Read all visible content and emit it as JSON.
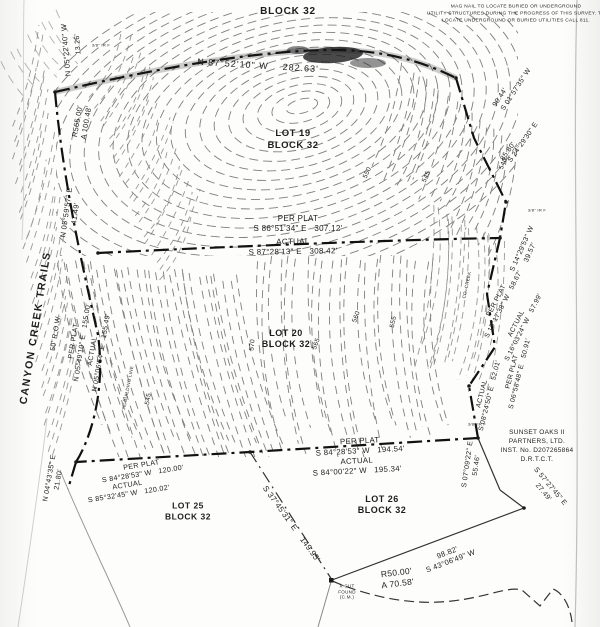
{
  "document": {
    "kind": "scanned survey plat",
    "street": "CANYON CREEK TRAILS",
    "right_of_way": "50' R.O.W.",
    "owner_record": "SUNSET OAKS II PARTNERS, LTD. INST. No. D207265864 D.R.T.C.T."
  },
  "labels": [
    {
      "id": "block-label-top",
      "text": "BLOCK 32",
      "x": 288,
      "y": 12,
      "fs": 10,
      "w": 700,
      "ls": 0.8
    },
    {
      "id": "utility-note",
      "text": "MAG NAIL TO LOCATE BURIED OR UNDERGROUND\nUTILITY STRUCTURES DURING THE PROGRESS OF THIS SURVEY. TO\nLOCATE UNDERGROUND OR BURIED UTILITIES CALL 811.",
      "x": 516,
      "y": 15,
      "fs": 4.8,
      "lh": 1.45
    },
    {
      "id": "bearing-top-n875210",
      "text": "N 87°52'10\" W    282.63'",
      "x": 258,
      "y": 66,
      "rot": 3.5,
      "fs": 9,
      "ls": 1
    },
    {
      "id": "dist-13-26",
      "text": "13.26'",
      "x": 79,
      "y": 44,
      "rot": -95,
      "fs": 7
    },
    {
      "id": "bearing-n052240",
      "text": "N 05°22'40\" W",
      "x": 66,
      "y": 50,
      "rot": -95,
      "fs": 7.5
    },
    {
      "id": "monument-irf-1",
      "text": "3/8\" IR F",
      "x": 101,
      "y": 45,
      "fs": 4
    },
    {
      "id": "curve-r565",
      "text": "R565.00'\nA 100.48'",
      "x": 82,
      "y": 122,
      "rot": -80,
      "fs": 7.5
    },
    {
      "id": "bearing-n055957",
      "text": "N 05°59'57\" E\n41.49'",
      "x": 71,
      "y": 213,
      "rot": -82,
      "fs": 7.5
    },
    {
      "id": "street-name",
      "text": "CANYON CREEK TRAILS",
      "x": 36,
      "y": 328,
      "rot": -81,
      "fs": 10.5,
      "ls": 1.5,
      "w": 600
    },
    {
      "id": "street-row",
      "text": "50' R.O.W.",
      "x": 57,
      "y": 333,
      "rot": -81,
      "fs": 7
    },
    {
      "id": "perplat-road",
      "text": "PER PLAT\nN 05°49'10\" E   155.00'",
      "x": 79,
      "y": 342,
      "rot": -81,
      "fs": 7
    },
    {
      "id": "actual-road",
      "text": "ACTUAL\nN 05°06'54\" E   155.49'",
      "x": 98,
      "y": 352,
      "rot": -80,
      "fs": 7
    },
    {
      "id": "building-line",
      "text": "30' BUILDING LINE",
      "x": 128,
      "y": 388,
      "rot": -79,
      "fs": 4.5
    },
    {
      "id": "contour-545-west",
      "text": "545",
      "x": 149,
      "y": 399,
      "rot": -80,
      "fs": 6.5
    },
    {
      "id": "bearing-n044335",
      "text": "N 04°43'35\" E\n21.80'",
      "x": 55,
      "y": 479,
      "rot": -80,
      "fs": 7
    },
    {
      "id": "lot19-label",
      "text": "LOT 19\nBLOCK 32",
      "x": 293,
      "y": 140,
      "fs": 9.5,
      "w": 700,
      "ls": 0.5
    },
    {
      "id": "perplat-mid",
      "text": "PER PLAT\nS 86°51'34\" E   307.12'",
      "x": 298,
      "y": 224,
      "fs": 8
    },
    {
      "id": "actual-mid",
      "text": "ACTUAL\nS 87°28'13\" E   308.42'",
      "x": 293,
      "y": 247,
      "rot": -1,
      "fs": 8
    },
    {
      "id": "lot20-label",
      "text": "LOT 20\nBLOCK 32",
      "x": 286,
      "y": 339,
      "fs": 9,
      "w": 700,
      "ls": 0.5
    },
    {
      "id": "contour-570",
      "text": "570",
      "x": 253,
      "y": 345,
      "rot": -85,
      "fs": 6.5
    },
    {
      "id": "contour-565",
      "text": "565",
      "x": 317,
      "y": 344,
      "rot": -70,
      "fs": 6.5
    },
    {
      "id": "contour-560",
      "text": "560",
      "x": 357,
      "y": 317,
      "rot": -70,
      "fs": 6.5
    },
    {
      "id": "contour-555",
      "text": "555",
      "x": 394,
      "y": 322,
      "rot": -78,
      "fs": 6.5
    },
    {
      "id": "contour-550",
      "text": "550",
      "x": 368,
      "y": 173,
      "rot": -65,
      "fs": 6.5
    },
    {
      "id": "contour-545-east",
      "text": "545",
      "x": 427,
      "y": 177,
      "rot": -65,
      "fs": 6.5
    },
    {
      "id": "contour-540",
      "text": "540",
      "x": 504,
      "y": 164,
      "rot": -68,
      "fs": 6.5
    },
    {
      "id": "creek-label",
      "text": "CO. CREEK",
      "x": 467,
      "y": 285,
      "rot": -78,
      "fs": 4.5
    },
    {
      "id": "bearing-s015735",
      "text": "S 01°57'35\" W",
      "x": 517,
      "y": 90,
      "rot": -57,
      "fs": 7
    },
    {
      "id": "dist-90-44",
      "text": "90.44'",
      "x": 501,
      "y": 98,
      "rot": -57,
      "fs": 7
    },
    {
      "id": "bearing-s242930",
      "text": "S 24°29'30\" E",
      "x": 524,
      "y": 143,
      "rot": -55,
      "fs": 7
    },
    {
      "id": "dist-85-80",
      "text": "85.80'",
      "x": 509,
      "y": 152,
      "rot": -55,
      "fs": 7
    },
    {
      "id": "monument-irf-2",
      "text": "3/8\" IR F",
      "x": 537,
      "y": 210,
      "fs": 4
    },
    {
      "id": "bearing-s142953",
      "text": "S 14°29'53\" W\n39.57'",
      "x": 527,
      "y": 251,
      "rot": -66,
      "fs": 7
    },
    {
      "id": "perplat-east1",
      "text": "PER PLAT\nS 15°17'38\" W   58.67'",
      "x": 501,
      "y": 303,
      "rot": -63,
      "fs": 6.8
    },
    {
      "id": "actual-east1",
      "text": "ACTUAL\nS 16°03'24\" W   57.99'",
      "x": 521,
      "y": 326,
      "rot": -63,
      "fs": 6.8
    },
    {
      "id": "perplat-east2",
      "text": "PER PLAT\nS 06°58'48\" E   50.91'",
      "x": 517,
      "y": 373,
      "rot": -76,
      "fs": 6.8
    },
    {
      "id": "actual-east2",
      "text": "ACTUAL\nS 08°24'50\" E   52.01'",
      "x": 487,
      "y": 395,
      "rot": -76,
      "fs": 6.8
    },
    {
      "id": "monument-irf-3",
      "text": "3/8\" IR F",
      "x": 477,
      "y": 424,
      "fs": 4
    },
    {
      "id": "bearing-s070922",
      "text": "S 07°09'22\" E\n55.46'",
      "x": 473,
      "y": 465,
      "rot": -82,
      "fs": 7
    },
    {
      "id": "owner-block",
      "text": "SUNSET OAKS II\nPARTNERS, LTD.\nINST. No. D207265864\nD.R.T.C.T.",
      "x": 537,
      "y": 446,
      "fs": 6.5,
      "lh": 1.4
    },
    {
      "id": "bearing-s572745",
      "text": "S 57°27'45\" E\n27.49'",
      "x": 546,
      "y": 490,
      "rot": 50,
      "fs": 7
    },
    {
      "id": "perplat-south",
      "text": "PER PLAT\nS 84°28'53\" W   194.54'",
      "x": 360,
      "y": 446,
      "rot": -3,
      "fs": 7.8
    },
    {
      "id": "actual-south",
      "text": "ACTUAL\nS 84°00'22\" W   195.34'",
      "x": 357,
      "y": 466,
      "rot": -3,
      "fs": 7.8
    },
    {
      "id": "perplat-southwest",
      "text": "PER PLAT\nS 84°28'53\" W   120.00'",
      "x": 142,
      "y": 469,
      "rot": -9,
      "fs": 7.2
    },
    {
      "id": "actual-southwest",
      "text": "ACTUAL\nS 85°32'45\" W   120.02'",
      "x": 128,
      "y": 489,
      "rot": -9,
      "fs": 7.2
    },
    {
      "id": "lot25-label",
      "text": "LOT 25\nBLOCK 32",
      "x": 188,
      "y": 511,
      "fs": 8.5,
      "w": 700,
      "ls": 0.5
    },
    {
      "id": "lot26-label",
      "text": "LOT 26\nBLOCK 32",
      "x": 382,
      "y": 505,
      "fs": 9,
      "w": 700,
      "ls": 0.5
    },
    {
      "id": "bearing-s374531",
      "text": "S 37°45'31\" E    149.95'",
      "x": 291,
      "y": 524,
      "rot": 54,
      "fs": 8
    },
    {
      "id": "xcut-note",
      "text": "X CUT\nFOUND\n(C.M.)",
      "x": 347,
      "y": 592,
      "fs": 4.5,
      "lh": 1.25
    },
    {
      "id": "curve-r50",
      "text": "R50.00'\nA 70.58'",
      "x": 397,
      "y": 578,
      "rot": -7,
      "fs": 8.5
    },
    {
      "id": "bearing-s430649",
      "text": "98.82'\nS 43°06'49\" W",
      "x": 449,
      "y": 557,
      "rot": -21,
      "fs": 7.5
    }
  ]
}
